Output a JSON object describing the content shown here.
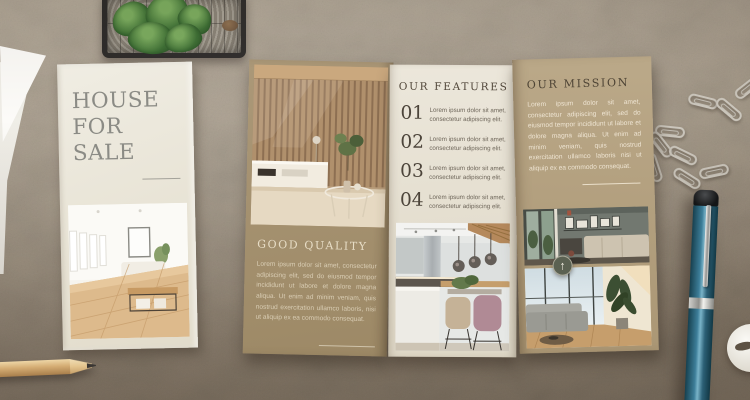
{
  "flyer": {
    "title_line1": "HOUSE",
    "title_line2": "FOR",
    "title_line3": "SALE"
  },
  "brochure": {
    "good_quality": {
      "heading": "GOOD QUALITY",
      "body": "Lorem ipsum dolor sit amet, consectetur adipiscing elit, sed do eiusmod tempor incididunt ut labore et dolore magna aliqua. Ut enim ad minim veniam, quis nostrud exercitation ullamco laboris, nisi ut aliquip ex ea commodo consequat."
    },
    "features": {
      "heading": "OUR FEATURES",
      "items": [
        {
          "number": "01",
          "text": "Lorem ipsum dolor sit amet, consectetur adipiscing elit."
        },
        {
          "number": "02",
          "text": "Lorem ipsum dolor sit amet, consectetur adipiscing elit."
        },
        {
          "number": "03",
          "text": "Lorem ipsum dolor sit amet, consectetur adipiscing elit."
        },
        {
          "number": "04",
          "text": "Lorem ipsum dolor sit amet, consectetur adipiscing elit."
        }
      ]
    },
    "mission": {
      "heading": "OUR MISSION",
      "body": "Lorem ipsum dolor sit amet, consectetur adipiscing elit, sed do eiusmod tempor incididunt ut labore et dolore magna aliqua. Ut enim ad minim veniam, quis nostrud exercitation ullamco laboris nisi ut aliquip ex ea commodo consequat."
    }
  },
  "icons": {
    "arrow_up": "↑"
  },
  "colors": {
    "desk_concrete": "#a69a8b",
    "flyer_cream": "#eae6da",
    "panel_dark_tan": "#a39070",
    "panel_cream": "#e7e1d3",
    "panel_tan": "#b3a182",
    "heading_dark": "#51473a",
    "heading_light": "#e7ddc6",
    "badge_olive": "#5b6152",
    "pen_teal": "#2c6076",
    "pencil_wood": "#d4ac73"
  }
}
